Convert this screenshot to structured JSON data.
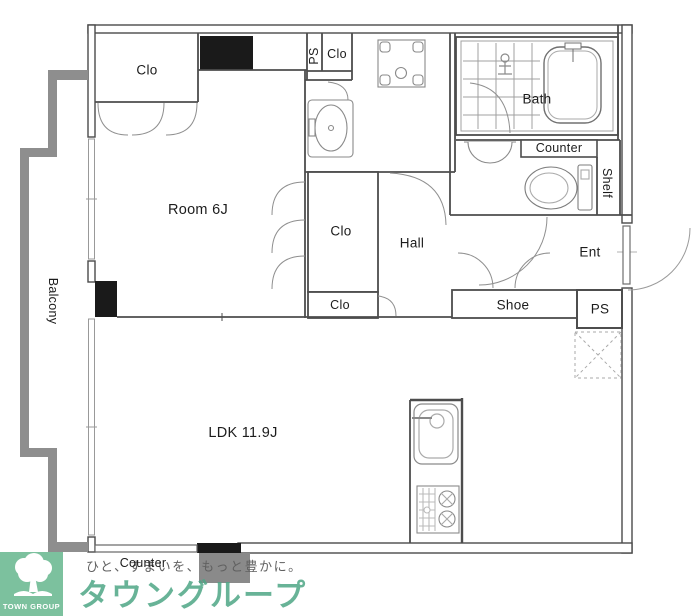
{
  "plan": {
    "labels": {
      "clo_top_left": "Clo",
      "ps_top": "PS",
      "clo_top": "Clo",
      "bath": "Bath",
      "counter_wc": "Counter",
      "shelf": "Shelf",
      "room": "Room 6J",
      "clo_mid": "Clo",
      "hall": "Hall",
      "ent": "Ent",
      "clo_small": "Clo",
      "shoe": "Shoe",
      "ps_entrance": "PS",
      "balcony": "Balcony",
      "ldk": "LDK 11.9J",
      "counter_kitchen": "Counter"
    },
    "colors": {
      "wall_line": "#4a4a4a",
      "balcony_gray": "#8e8e8e",
      "pillar_black": "#1a1a1a"
    }
  },
  "branding": {
    "logo_text": "TOWN GROUP",
    "brand_name": "タウングループ",
    "tagline": "ひと、すまいを、もっと豊かに。",
    "colors": {
      "logo_green": "#7cc19e",
      "brand_green": "#4ea686"
    }
  }
}
